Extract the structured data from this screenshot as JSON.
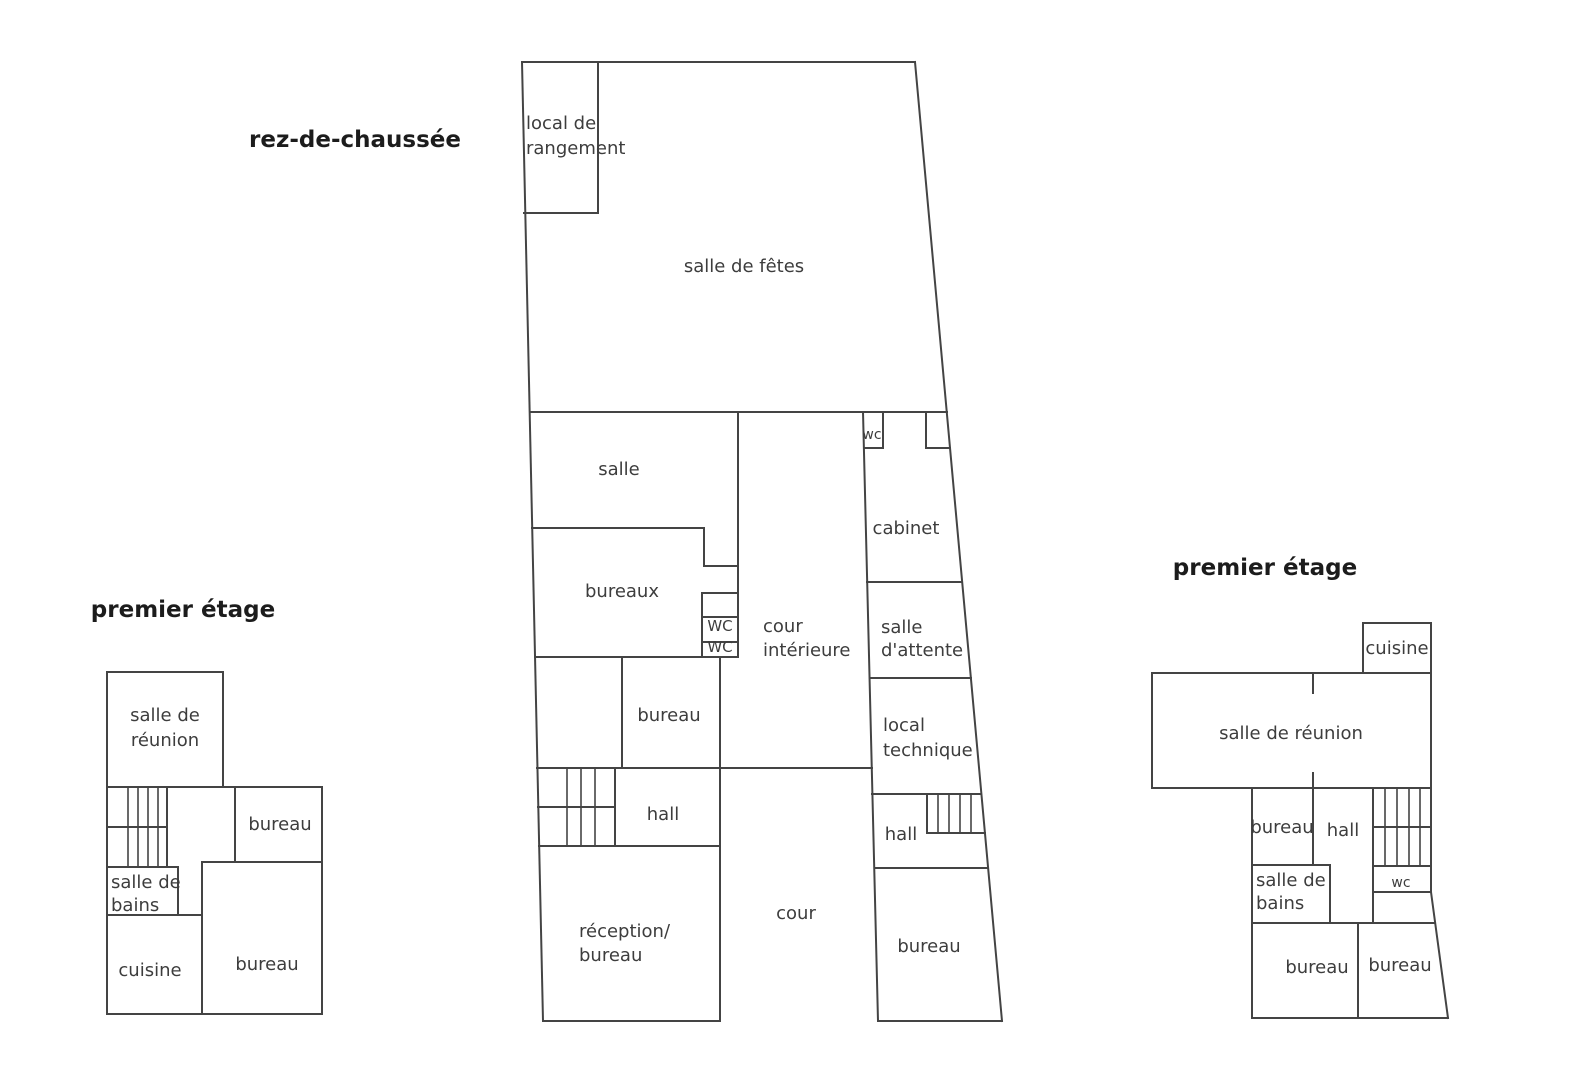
{
  "palette": {
    "background": "#ffffff",
    "wall": "#444444",
    "text": "#3d3d3d",
    "title_text": "#1c1c1c"
  },
  "ground_floor": {
    "title": "rez-de-chaussée",
    "rooms": {
      "local_de_rangement": [
        "local de",
        "rangement"
      ],
      "salle_de_fetes": "salle de fêtes",
      "salle": "salle",
      "bureaux": "bureaux",
      "wc_a": "WC",
      "wc_b": "WC",
      "wc_c": "wc",
      "cour_interieure": [
        "cour",
        "intérieure"
      ],
      "cabinet": "cabinet",
      "salle_d_attente": [
        "salle",
        "d'attente"
      ],
      "local_technique": [
        "local",
        "technique"
      ],
      "bureau_centre": "bureau",
      "hall_ouest": "hall",
      "reception_bureau": [
        "réception/",
        "bureau"
      ],
      "cour": "cour",
      "hall_est": "hall",
      "bureau_est": "bureau"
    }
  },
  "first_floor_west": {
    "title": "premier étage",
    "rooms": {
      "salle_de_reunion": [
        "salle de",
        "réunion"
      ],
      "bureau_nord": "bureau",
      "salle_de_bains": [
        "salle de",
        "bains"
      ],
      "cuisine": "cuisine",
      "bureau_sud": "bureau"
    }
  },
  "first_floor_east": {
    "title": "premier étage",
    "rooms": {
      "cuisine": "cuisine",
      "salle_de_reunion": "salle de réunion",
      "bureau_nord": "bureau",
      "hall": "hall",
      "wc": "wc",
      "salle_de_bains": [
        "salle de",
        "bains"
      ],
      "bureau_sud_ouest": "bureau",
      "bureau_sud_est": "bureau"
    }
  }
}
